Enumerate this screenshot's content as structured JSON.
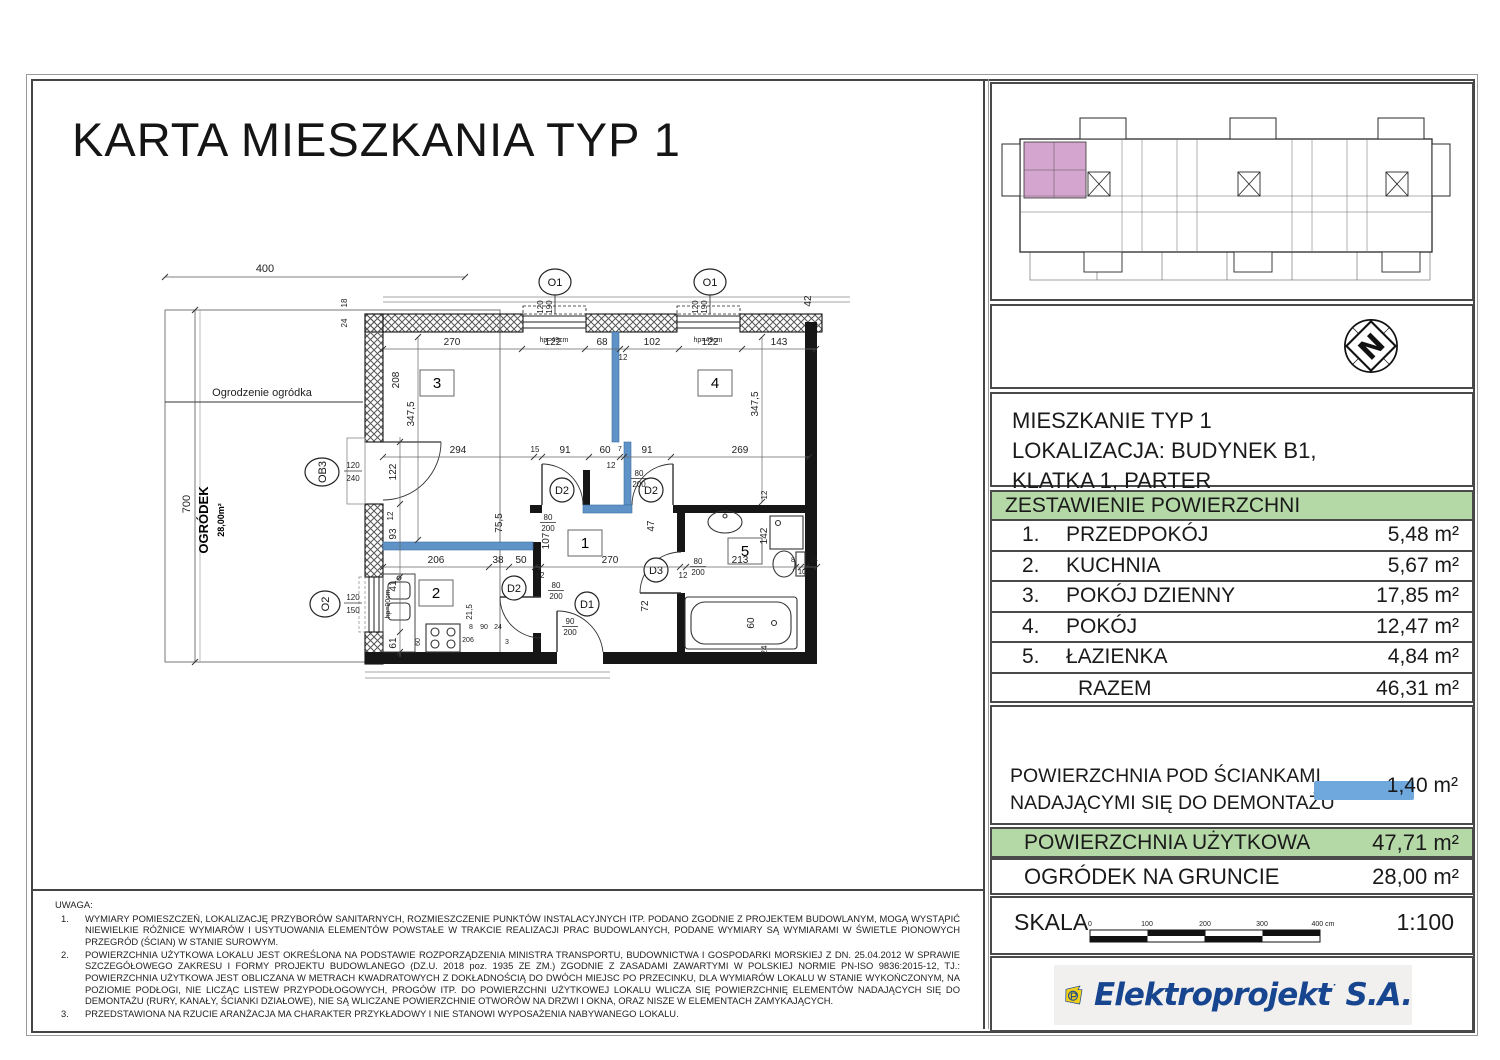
{
  "title": "KARTA MIESZKANIA TYP 1",
  "location": {
    "line1": "MIESZKANIE TYP 1",
    "line2": "LOKALIZACJA: BUDYNEK B1,",
    "line3": "KLATKA 1, PARTER"
  },
  "areas": {
    "header": "ZESTAWIENIE POWIERZCHNI",
    "rows": [
      {
        "no": "1.",
        "name": "PRZEDPOKÓJ",
        "area": "5,48 m²"
      },
      {
        "no": "2.",
        "name": "KUCHNIA",
        "area": "5,67 m²"
      },
      {
        "no": "3.",
        "name": "POKÓJ DZIENNY",
        "area": "17,85 m²"
      },
      {
        "no": "4.",
        "name": "POKÓJ",
        "area": "12,47 m²"
      },
      {
        "no": "5.",
        "name": "ŁAZIENKA",
        "area": "4,84 m²"
      }
    ],
    "total_label": "RAZEM",
    "total_area": "46,31 m²"
  },
  "demolition": {
    "line1": "POWIERZCHNIA POD ŚCIANKAMI",
    "line2": "NADAJĄCYMI SIĘ DO DEMONTAŻU",
    "area": "1,40 m²",
    "bar_color": "#6fa8dc"
  },
  "usable": {
    "label": "POWIERZCHNIA UŻYTKOWA",
    "area": "47,71 m²"
  },
  "garden_row": {
    "label": "OGRÓDEK NA GRUNCIE",
    "area": "28,00 m²"
  },
  "scale": {
    "label": "SKALA",
    "value": "1:100",
    "t0": "0",
    "t1": "100",
    "t2": "200",
    "t3": "300",
    "t4": "400 cm"
  },
  "logo": {
    "brand": "Elektroprojekt",
    "suffix": " S.A."
  },
  "notes": {
    "heading": "UWAGA:",
    "items": [
      "WYMIARY POMIESZCZEŃ, LOKALIZACJĘ PRZYBORÓW SANITARNYCH, ROZMIESZCZENIE PUNKTÓW INSTALACYJNYCH ITP. PODANO ZGODNIE Z PROJEKTEM BUDOWLANYM, MOGĄ WYSTĄPIĆ NIEWIELKIE RÓŻNICE WYMIARÓW I USYTUOWANIA ELEMENTÓW POWSTAŁE W TRAKCIE REALIZACJI PRAC BUDOWLANYCH, PODANE WYMIARY SĄ WYMIARAMI W ŚWIETLE PIONOWYCH PRZEGRÓD (ŚCIAN) W STANIE SUROWYM.",
      "POWIERZCHNIA UŻYTKOWA LOKALU JEST OKREŚLONA NA PODSTAWIE ROZPORZĄDZENIA MINISTRA TRANSPORTU, BUDOWNICTWA I GOSPODARKI MORSKIEJ Z DN. 25.04.2012 W SPRAWIE SZCZEGÓŁOWEGO ZAKRESU I FORMY PROJEKTU BUDOWLANEGO (DZ.U. 2018 poz. 1935 ZE ZM.) ZGODNIE Z ZASADAMI ZAWARTYMI W POLSKIEJ NORMIE PN-ISO 9836:2015-12, TJ.: POWIERZCHNIA UŻYTKOWA JEST OBLICZANA W METRACH KWADRATOWYCH Z DOKŁADNOŚCIĄ DO DWÓCH MIEJSC PO PRZECINKU, DLA WYMIARÓW LOKALU W STANIE WYKOŃCZONYM, NA POZIOMIE PODŁOGI, NIE LICZĄC LISTEW PRZYPODŁOGOWYCH, PROGÓW ITP. DO POWIERZCHNI UŻYTKOWEJ LOKALU WLICZA SIĘ POWIERZCHNIĘ ELEMENTÓW NADAJĄCYCH SIĘ DO DEMONTAŻU (RURY, KANAŁY, ŚCIANKI DZIAŁOWE), NIE SĄ WLICZANE POWIERZCHNIE OTWORÓW NA DRZWI I OKNA, ORAZ NISZE W ELEMENTACH ZAMYKAJĄCYCH.",
      "PRZEDSTAWIONA NA RZUCIE ARANŻACJA MA CHARAKTER PRZYKŁADOWY I NIE STANOWI WYPOSAŻENIA NABYWANEGO LOKALU."
    ]
  },
  "plan": {
    "garden": {
      "fence": "Ogrodzenie ogródka",
      "name": "OGRÓDEK",
      "area": "28,00m²",
      "w": "400",
      "h": "700"
    },
    "rooms": {
      "r1": "1",
      "r2": "2",
      "r3": "3",
      "r4": "4",
      "r5": "5"
    },
    "win": {
      "o1": "O1",
      "o1w": "120",
      "o1h": "190",
      "sill1": "hp=49cm",
      "ob3": "OB3",
      "ob3w": "120",
      "ob3h": "240",
      "o2": "O2",
      "o2w": "120",
      "o2h": "150",
      "sill2": "hp=90cm"
    },
    "door": {
      "d1": "D1",
      "d1w": "90",
      "d1h": "200",
      "d2": "D2",
      "d2w": "80",
      "d2h": "200",
      "d3": "D3",
      "d3w": "80",
      "d3h": "200"
    },
    "dims": {
      "top": [
        "270",
        "122",
        "68",
        "12",
        "102",
        "122",
        "143"
      ],
      "mid": [
        "294",
        "15",
        "91",
        "60",
        "7",
        "91",
        "269",
        "12"
      ],
      "low": [
        "206",
        "38",
        "50",
        "12",
        "270",
        "12",
        "213",
        "8",
        "10",
        "24"
      ],
      "v": [
        "18",
        "24",
        "208",
        "347,5",
        "347,5",
        "122",
        "12",
        "93",
        "41",
        "61",
        "75,5",
        "107",
        "47",
        "72",
        "142",
        "12",
        "60",
        "24",
        "42",
        "21,5"
      ],
      "k": [
        "206",
        "60",
        "8",
        "90",
        "24",
        "3"
      ]
    }
  }
}
